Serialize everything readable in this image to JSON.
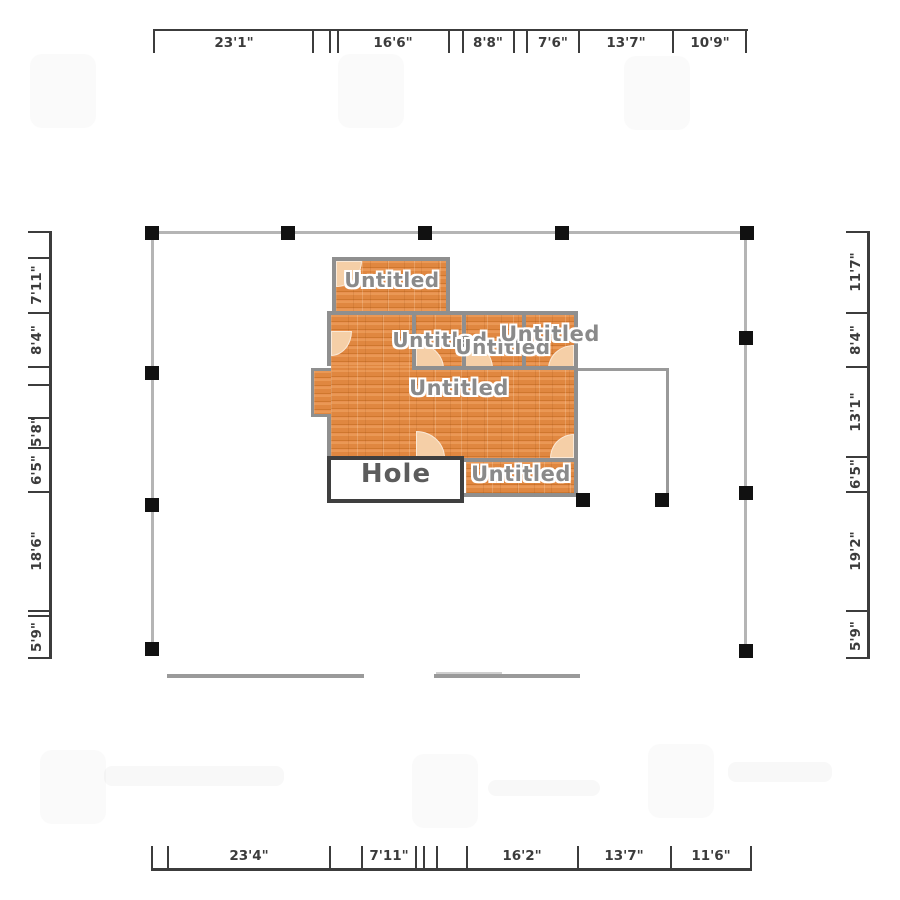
{
  "dimensions": {
    "top": {
      "labels": [
        "23'1\"",
        "16'6\"",
        "8'8\"",
        "7'6\"",
        "13'7\"",
        "10'9\""
      ]
    },
    "bottom": {
      "labels": [
        "23'4\"",
        "7'11\"",
        "16'2\"",
        "13'7\"",
        "11'6\""
      ]
    },
    "left": {
      "labels": [
        "7'11\"",
        "8'4\"",
        "5'8\"",
        "6'5\"",
        "18'6\"",
        "5'9\""
      ]
    },
    "right": {
      "labels": [
        "11'7\"",
        "8'4\"",
        "13'1\"",
        "6'5\"",
        "19'2\"",
        "5'9\""
      ]
    }
  },
  "rooms": {
    "top_room": "Untitled",
    "row_room_a": "Untitled",
    "row_room_b": "Untitled",
    "row_room_c": "Untitled",
    "main_room": "Untitled",
    "bottom_right_room": "Untitled"
  },
  "hole": {
    "label": "Hole"
  },
  "colors": {
    "floor": "#e18a44",
    "wall": "#8f8f8f",
    "selection_line": "#b5b5b5",
    "handle": "#111111",
    "door_arc": "#f5cfa7",
    "dim_text": "#3b3b3b",
    "room_label": "#8a8a8a",
    "hole_border": "#3f3f3f"
  }
}
